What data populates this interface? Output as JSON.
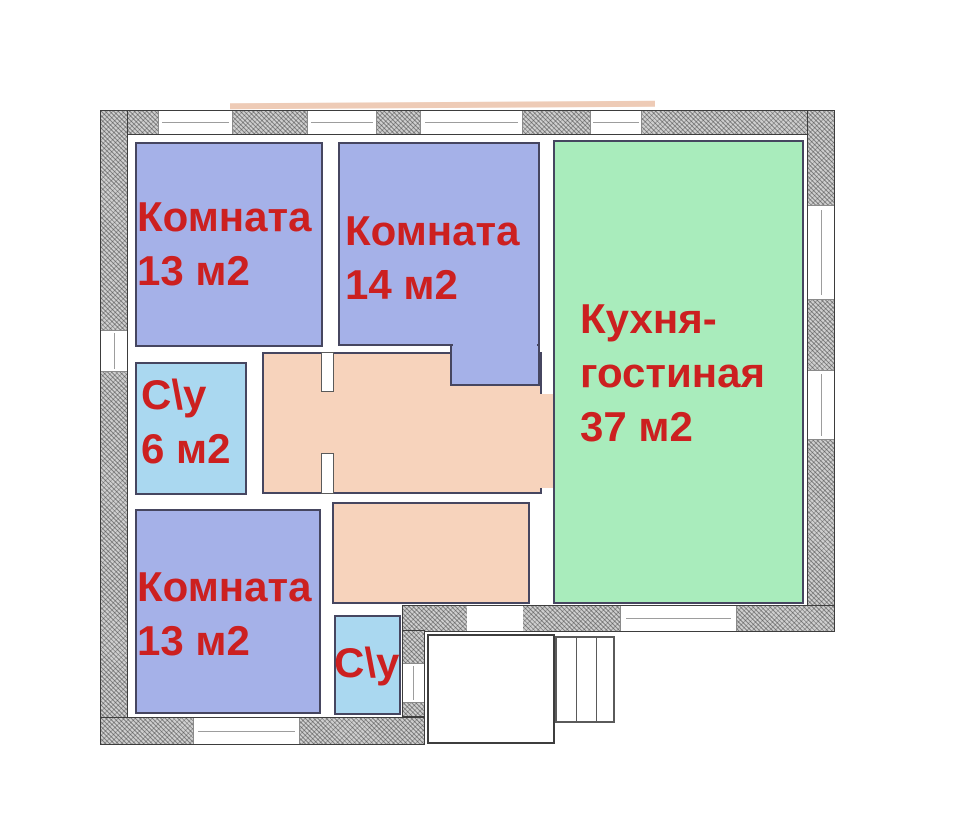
{
  "plan_type": "floor-plan",
  "rooms": {
    "room13_top": {
      "name": "Комната",
      "area": "13 м2"
    },
    "room14": {
      "name": "Комната",
      "area": "14 м2"
    },
    "kitchen": {
      "line1": "Кухня-",
      "line2": "гостиная",
      "area": "37 м2"
    },
    "bath6": {
      "name": "С\\у",
      "area": "6 м2"
    },
    "room13_bottom": {
      "name": "Комната",
      "area": "13 м2"
    },
    "bath_small": {
      "name": "С\\у"
    }
  },
  "colors": {
    "room_blue": "#a5b1e8",
    "bath_blue": "#aad8f0",
    "kitchen_green": "#a9ecbc",
    "hall_salmon": "#f7d3bc",
    "label_red": "#cc2020",
    "wall_gray": "#cfcfcf"
  }
}
